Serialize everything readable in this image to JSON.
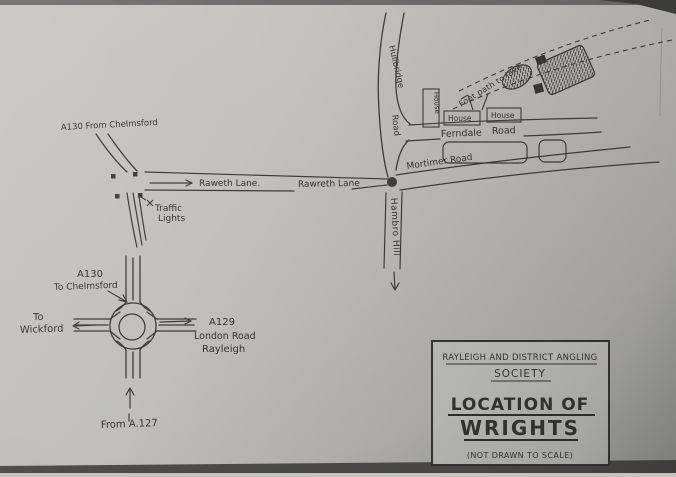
{
  "colors": {
    "paper": "#c6c3bf",
    "ink": "#3f3d3a",
    "shadow": "#4c4a47"
  },
  "map": {
    "a130_from_label": "A130 From Chelmsford",
    "rawreth_lane_west": "Raweth Lane.",
    "rawreth_lane_mid": "Rawreth Lane",
    "traffic_lights": [
      "Traffic",
      "Lights"
    ],
    "hullbridge_road": [
      "Hullbridge",
      "Road"
    ],
    "ferndale_road": [
      "Ferndale",
      "Road"
    ],
    "mortimer_road": "Mortimer Road",
    "hambro_hill": "Hambro Hill",
    "footpath": "Foot path to lake",
    "houses": [
      "House",
      "House",
      "House"
    ],
    "roundabout": {
      "a130": "A130",
      "to_chelmsford": "To Chelmsford",
      "to": "To",
      "wickford": "Wickford",
      "a129": "A129",
      "london_road": "London Road",
      "rayleigh": "Rayleigh",
      "from_a127": "From A.127"
    }
  },
  "title_box": {
    "org_line1": "RAYLEIGH AND DISTRICT ANGLING",
    "org_line2": "SOCIETY",
    "title_line1": "LOCATION OF",
    "title_line2": "WRIGHTS",
    "note": "(NOT DRAWN TO SCALE)"
  }
}
